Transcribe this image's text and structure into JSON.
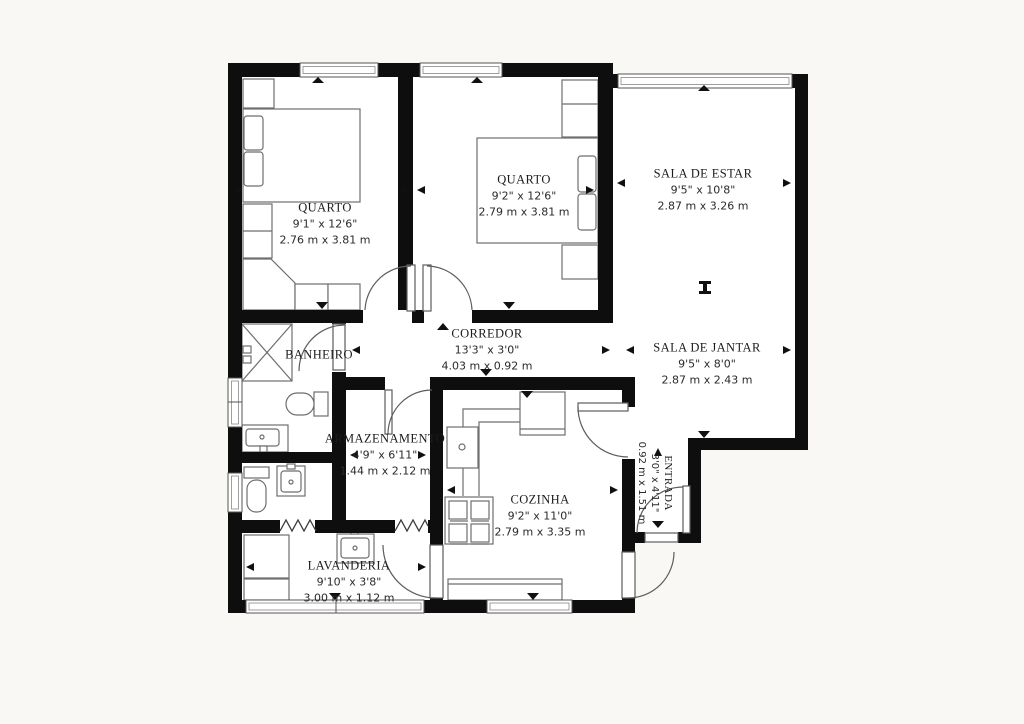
{
  "page": {
    "background": "#faf8f5",
    "floor_fill": "#ffffff",
    "wall_color": "#0e0e0e",
    "fixture_line_color": "#6e6e6e",
    "text_color": "#1b1b1b"
  },
  "rooms": [
    {
      "name": "QUARTO",
      "dim_ft": "9'1\" x 12'6\"",
      "dim_m": "2.76 m x 3.81 m"
    },
    {
      "name": "QUARTO",
      "dim_ft": "9'2\" x 12'6\"",
      "dim_m": "2.79 m x 3.81 m"
    },
    {
      "name": "SALA DE ESTAR",
      "dim_ft": "9'5\" x 10'8\"",
      "dim_m": "2.87 m x 3.26 m"
    },
    {
      "name": "SALA DE JANTAR",
      "dim_ft": "9'5\" x 8'0\"",
      "dim_m": "2.87 m x 2.43 m"
    },
    {
      "name": "CORREDOR",
      "dim_ft": "13'3\" x 3'0\"",
      "dim_m": "4.03 m x 0.92 m"
    },
    {
      "name": "BANHEIRO",
      "dim_ft": "",
      "dim_m": ""
    },
    {
      "name": "ARMAZENAMENTO",
      "dim_ft": "4'9\" x 6'11\"",
      "dim_m": "1.44 m x 2.12 m"
    },
    {
      "name": "COZINHA",
      "dim_ft": "9'2\" x 11'0\"",
      "dim_m": "2.79 m x 3.35 m"
    },
    {
      "name": "LAVANDERIA",
      "dim_ft": "9'10\" x 3'8\"",
      "dim_m": "3.00 m x 1.12 m"
    },
    {
      "name": "ENTRADA",
      "dim_ft": "3'0\" x 4'11\"",
      "dim_m": "0.92 m x 1.51 m"
    }
  ]
}
